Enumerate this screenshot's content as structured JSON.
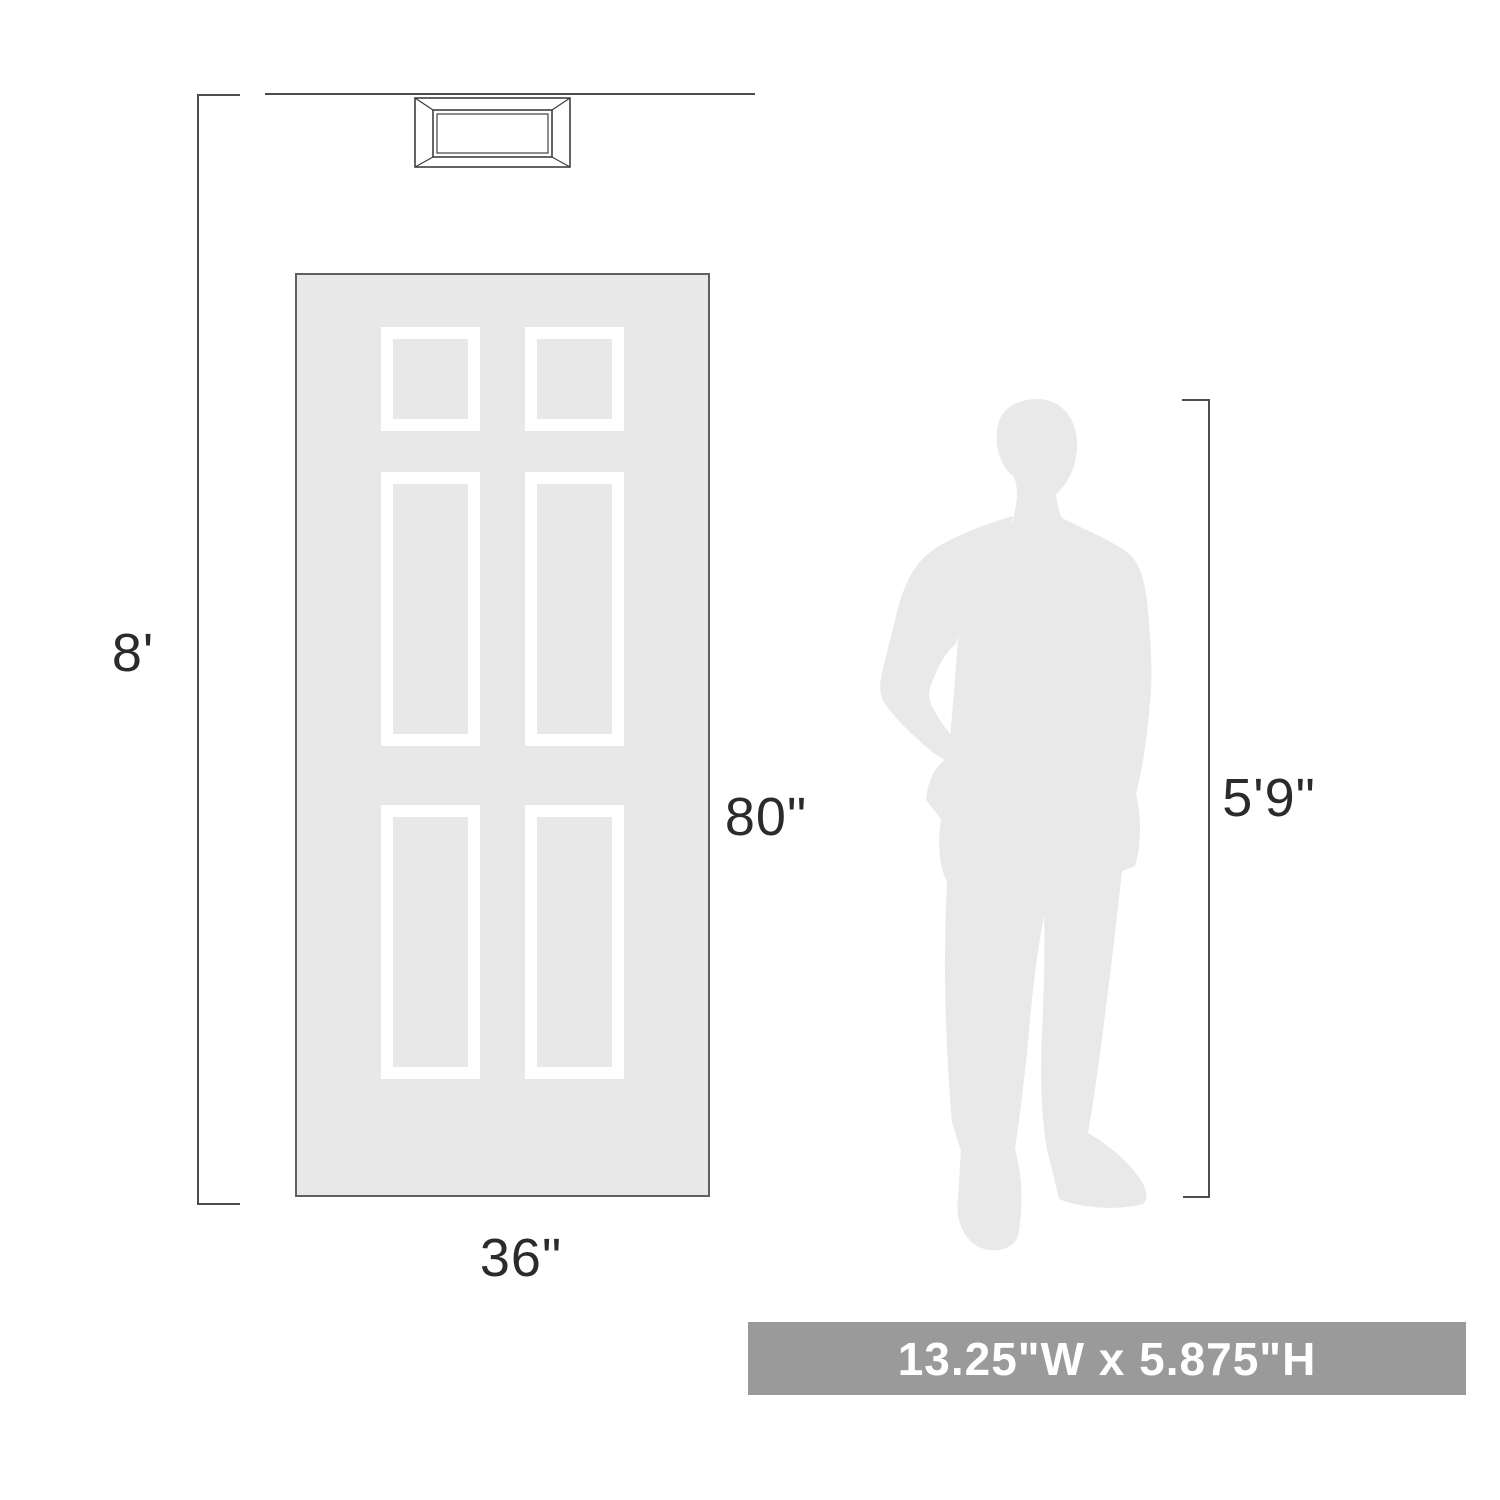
{
  "labels": {
    "wall_height": "8'",
    "door_height": "80\"",
    "door_width": "36\"",
    "person_height": "5'9\""
  },
  "banner": {
    "text": "13.25\"W x 5.875\"H"
  },
  "colors": {
    "door-fill": "#e8e8e8",
    "door-border": "#606060",
    "panel-frame": "#ffffff",
    "silhouette-fill": "#e9e9e9",
    "line-color": "#4d4d4d",
    "label-color": "#2b2b2b",
    "banner-bg": "#9a9a9a",
    "banner-text": "#ffffff",
    "fixture-line": "#3f3f3f"
  }
}
